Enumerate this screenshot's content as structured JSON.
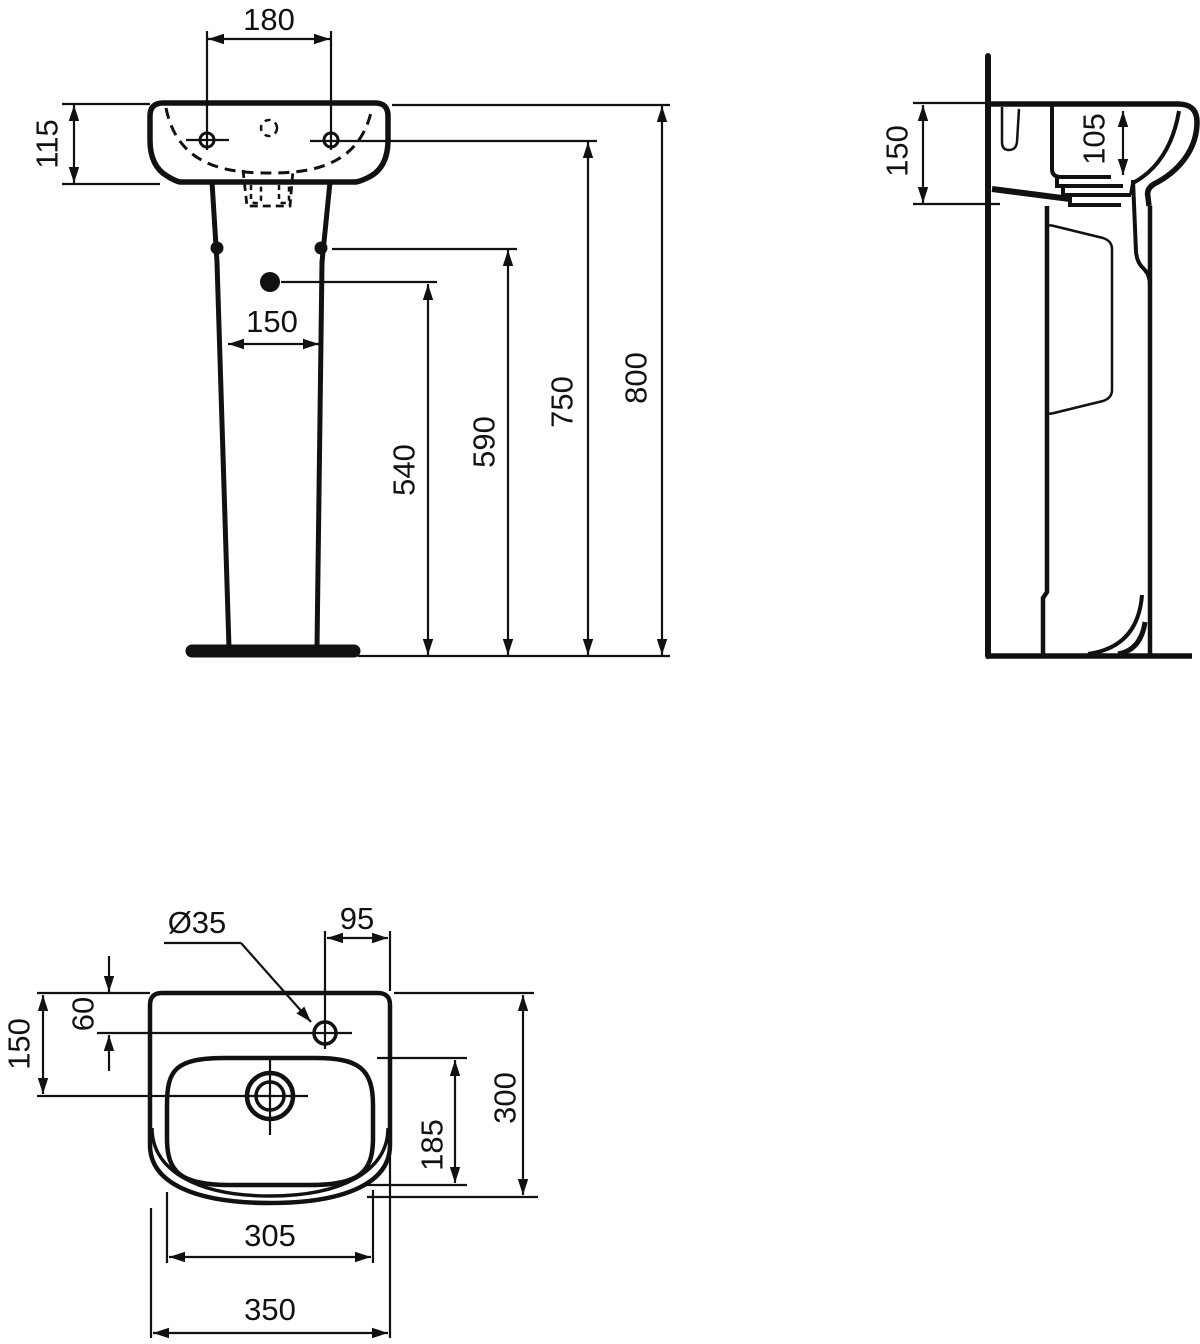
{
  "drawing": {
    "type": "technical-dimension-drawing",
    "subject": "pedestal-washbasin",
    "views": [
      "front-elevation",
      "side-section",
      "top-plan"
    ],
    "units": "mm",
    "colors": {
      "ink": "#111111",
      "background": "#ffffff"
    }
  },
  "labels": {
    "front": {
      "hole_spacing": "180",
      "rim_height": "115",
      "pedestal_width": "150",
      "dim_540": "540",
      "dim_590": "590",
      "dim_750": "750",
      "dim_800": "800"
    },
    "side": {
      "rim_depth": "150",
      "bowl_depth": "105"
    },
    "plan": {
      "tap_hole_dia": "Ø35",
      "tap_offset_right": "95",
      "tap_offset_back": "60",
      "drain_offset_back": "150",
      "bowl_depth": "185",
      "overall_depth": "300",
      "bowl_width": "305",
      "overall_width": "350"
    }
  }
}
